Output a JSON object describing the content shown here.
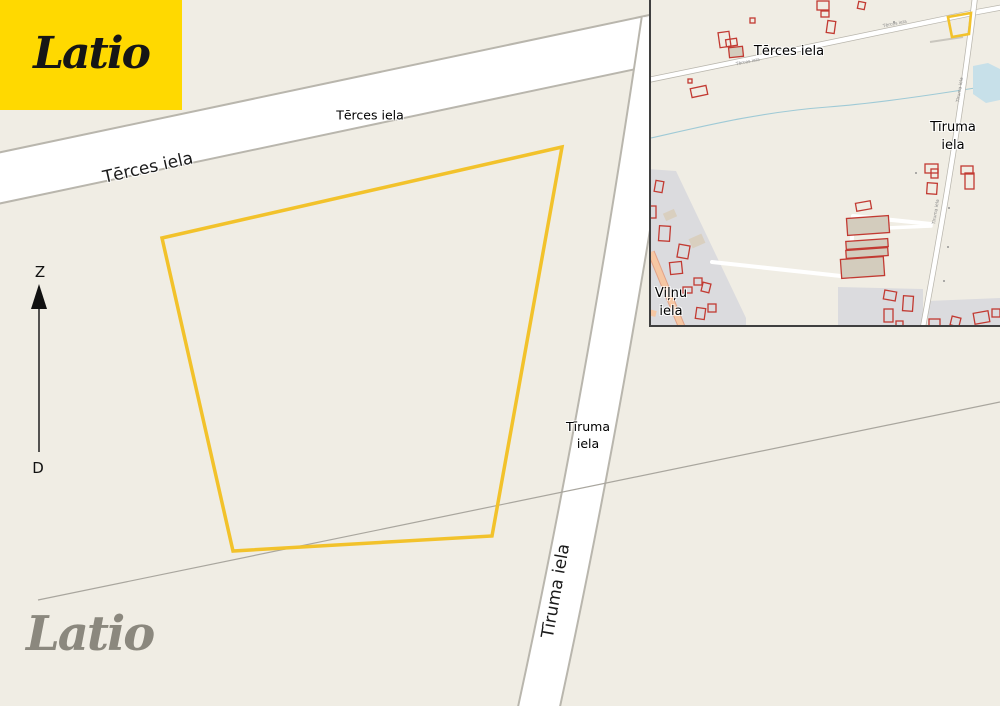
{
  "brand": {
    "logo_text": "Latio",
    "watermark_text": "Latio"
  },
  "colors": {
    "background": "#F0EDE4",
    "label": "#000000",
    "road_fill": "#FFFFFF",
    "road_casing": "#B9B6AD",
    "parcel": "#F2C22B",
    "building": "#C23A32",
    "building_fill": "#D3CCBD",
    "residential": "#DBDBDE",
    "water": "#C7E0E9",
    "stream": "#9FCAD6",
    "minor_road": "#F6C7A3",
    "logo_bg": "#FFD900",
    "logo_text": "#161616",
    "watermark": "#8B887E"
  },
  "compass": {
    "north_label": "Z",
    "south_label": "D"
  },
  "main_map": {
    "parcel_points": "562,147 162,238 233,551 492,536",
    "streets": {
      "terces_horizontal": "Tērces iela",
      "terces_on_road": "Tērces iela",
      "tiruma_line1": "Tīruma",
      "tiruma_line2": "iela",
      "tiruma_on_road": "Tīruma iela"
    }
  },
  "inset_map": {
    "parcel_points": "948,17 971,13 969,34 952,37",
    "streets": {
      "terces": "Tērces iela",
      "tiruma_line1": "Tīruma",
      "tiruma_line2": "iela",
      "vilnu_line1": "Viļņu",
      "vilnu_line2": "iela"
    },
    "tiny_labels": {
      "terces": "Tērces iela",
      "tiruma": "Tīruma iela"
    },
    "buildings": [
      {
        "x": 750,
        "y": 18,
        "w": 5,
        "h": 5
      },
      {
        "x": 719,
        "y": 32,
        "w": 11,
        "h": 15,
        "r": -8
      },
      {
        "x": 726,
        "y": 39,
        "w": 11,
        "h": 7,
        "r": -8
      },
      {
        "x": 729,
        "y": 47,
        "w": 14,
        "h": 10,
        "r": -6,
        "t": "f"
      },
      {
        "x": 688,
        "y": 79,
        "w": 4,
        "h": 4
      },
      {
        "x": 691,
        "y": 87,
        "w": 16,
        "h": 9,
        "r": -12
      },
      {
        "x": 817,
        "y": 1,
        "w": 12,
        "h": 9
      },
      {
        "x": 821,
        "y": 11,
        "w": 8,
        "h": 6
      },
      {
        "x": 858,
        "y": 2,
        "w": 7,
        "h": 7,
        "r": 12
      },
      {
        "x": 827,
        "y": 21,
        "w": 8,
        "h": 12,
        "r": 8
      },
      {
        "x": 925,
        "y": 164,
        "w": 13,
        "h": 9
      },
      {
        "x": 931,
        "y": 169,
        "w": 7,
        "h": 9
      },
      {
        "x": 927,
        "y": 183,
        "w": 10,
        "h": 11,
        "r": 4
      },
      {
        "x": 961,
        "y": 166,
        "w": 12,
        "h": 8
      },
      {
        "x": 965,
        "y": 173,
        "w": 9,
        "h": 16
      },
      {
        "x": 655,
        "y": 181,
        "w": 8,
        "h": 11,
        "r": 10
      },
      {
        "x": 648,
        "y": 206,
        "w": 8,
        "h": 12
      },
      {
        "x": 659,
        "y": 226,
        "w": 11,
        "h": 15,
        "r": 4
      },
      {
        "x": 678,
        "y": 245,
        "w": 11,
        "h": 13,
        "r": 10
      },
      {
        "x": 670,
        "y": 262,
        "w": 12,
        "h": 12,
        "r": -6
      },
      {
        "x": 694,
        "y": 278,
        "w": 8,
        "h": 7
      },
      {
        "x": 702,
        "y": 283,
        "w": 8,
        "h": 9,
        "r": 14
      },
      {
        "x": 683,
        "y": 287,
        "w": 9,
        "h": 6
      },
      {
        "x": 696,
        "y": 308,
        "w": 9,
        "h": 11,
        "r": 8
      },
      {
        "x": 708,
        "y": 304,
        "w": 8,
        "h": 8
      },
      {
        "x": 664,
        "y": 211,
        "w": 12,
        "h": 8,
        "r": -24,
        "t": "tan"
      },
      {
        "x": 690,
        "y": 236,
        "w": 14,
        "h": 10,
        "r": -24,
        "t": "tan"
      },
      {
        "x": 856,
        "y": 202,
        "w": 15,
        "h": 8,
        "r": -10
      },
      {
        "x": 847,
        "y": 217,
        "w": 42,
        "h": 17,
        "r": -4,
        "t": "f"
      },
      {
        "x": 846,
        "y": 240,
        "w": 42,
        "h": 8,
        "r": -4,
        "t": "f"
      },
      {
        "x": 846,
        "y": 249,
        "w": 42,
        "h": 8,
        "r": -4,
        "t": "f"
      },
      {
        "x": 841,
        "y": 258,
        "w": 43,
        "h": 19,
        "r": -4,
        "t": "f"
      },
      {
        "x": 884,
        "y": 291,
        "w": 12,
        "h": 9,
        "r": 10
      },
      {
        "x": 903,
        "y": 296,
        "w": 10,
        "h": 15,
        "r": 4
      },
      {
        "x": 884,
        "y": 309,
        "w": 9,
        "h": 13
      },
      {
        "x": 896,
        "y": 321,
        "w": 7,
        "h": 6
      },
      {
        "x": 929,
        "y": 319,
        "w": 11,
        "h": 8
      },
      {
        "x": 951,
        "y": 317,
        "w": 9,
        "h": 9,
        "r": 14
      },
      {
        "x": 974,
        "y": 312,
        "w": 15,
        "h": 11,
        "r": -10
      },
      {
        "x": 992,
        "y": 309,
        "w": 8,
        "h": 8
      },
      {
        "x": 915,
        "y": 172,
        "w": 2,
        "h": 2,
        "t": "s"
      },
      {
        "x": 948,
        "y": 207,
        "w": 2,
        "h": 2,
        "t": "s"
      },
      {
        "x": 947,
        "y": 246,
        "w": 2,
        "h": 2,
        "t": "s"
      },
      {
        "x": 943,
        "y": 280,
        "w": 2,
        "h": 2,
        "t": "s"
      },
      {
        "x": 893,
        "y": 21,
        "w": 2,
        "h": 2,
        "t": "s"
      }
    ]
  }
}
